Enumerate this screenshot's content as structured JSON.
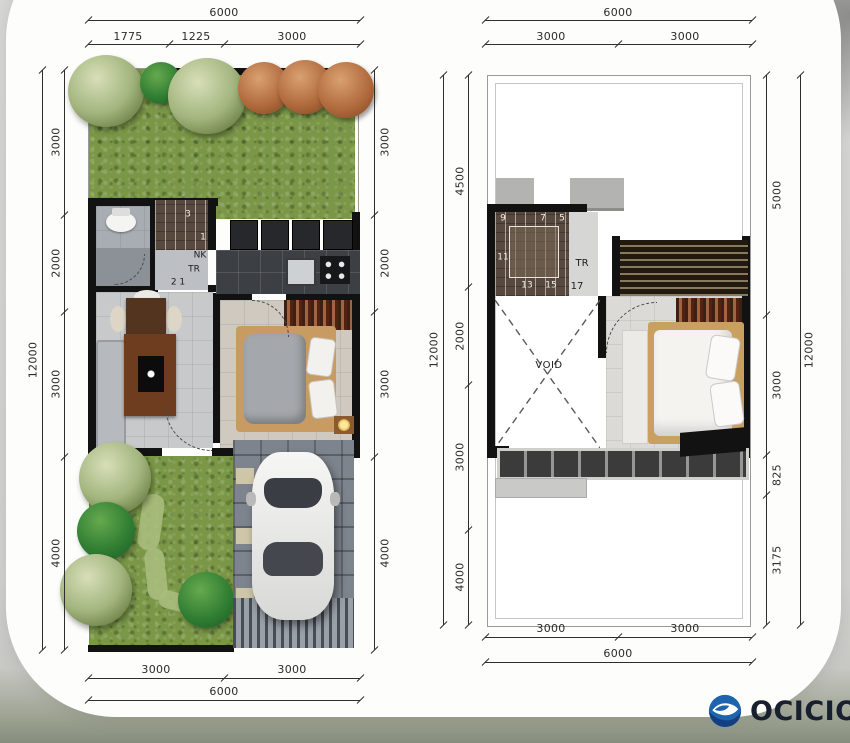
{
  "background": {
    "brand_text": "OCICIO"
  },
  "ground_floor": {
    "top": {
      "overall": "6000",
      "segments": [
        "1775",
        "1225",
        "3000"
      ]
    },
    "left": {
      "overall": "12000",
      "segments": [
        "3000",
        "2000",
        "3000",
        "4000"
      ]
    },
    "right": {
      "segments": [
        "3000",
        "2000",
        "3000",
        "4000"
      ]
    },
    "bottom": {
      "overall": "6000",
      "segments": [
        "3000",
        "3000"
      ]
    },
    "stair_labels": {
      "n3": "3",
      "n1": "1",
      "nk": "NK",
      "tr": "TR",
      "n21": "2 1"
    }
  },
  "upper_floor": {
    "top": {
      "overall": "6000",
      "segments": [
        "3000",
        "3000"
      ]
    },
    "left": {
      "overall": "12000",
      "segments": [
        "4500",
        "2000",
        "3000",
        "4000"
      ]
    },
    "right": {
      "overall": "12000",
      "segments": [
        "5000",
        "3000",
        "825",
        "3175"
      ]
    },
    "bottom": {
      "overall": "6000",
      "segments": [
        "3000",
        "3000"
      ]
    },
    "stair_labels": {
      "n9": "9",
      "n7": "7",
      "n5": "5",
      "n11": "11",
      "n13": "13",
      "n15": "15",
      "tr": "TR",
      "n17": "17"
    },
    "void_label": "VOID"
  }
}
